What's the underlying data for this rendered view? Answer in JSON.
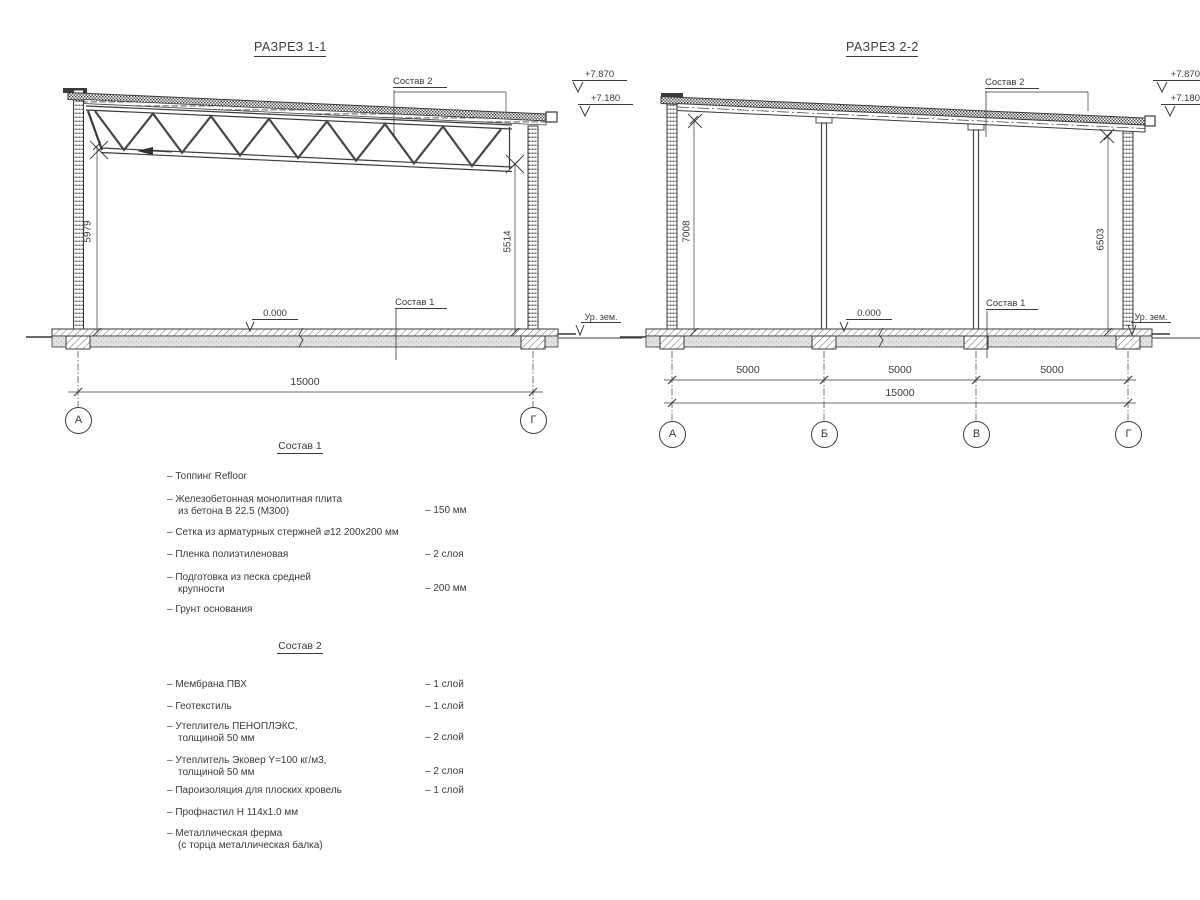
{
  "drawing": {
    "section1": {
      "title": "РАЗРЕЗ 1-1",
      "elev_top": "+7.870",
      "elev_mid": "+7.180",
      "elev_zero": "0.000",
      "ground": "Ур. зем.",
      "callout_roof": "Состав 2",
      "callout_floor": "Состав 1",
      "dim_left": "5979",
      "dim_right": "5514",
      "dim_total": "15000",
      "axes": [
        "А",
        "Г"
      ]
    },
    "section2": {
      "title": "РАЗРЕЗ 2-2",
      "elev_top": "+7.870",
      "elev_mid": "+7.180",
      "elev_zero": "0.000",
      "ground": "Ур. зем.",
      "callout_roof": "Состав 2",
      "callout_floor": "Состав 1",
      "dim_left": "7008",
      "dim_right": "6503",
      "dim_spans": [
        "5000",
        "5000",
        "5000"
      ],
      "dim_total": "15000",
      "axes": [
        "А",
        "Б",
        "В",
        "Г"
      ]
    }
  },
  "lists": {
    "sostav1": {
      "title": "Состав 1",
      "items": [
        {
          "l1": "– Топпинг Refloor",
          "l2": "",
          "val": ""
        },
        {
          "l1": "– Железобетонная монолитная плита",
          "l2": "из бетона В 22.5 (М300)",
          "val": "– 150 мм"
        },
        {
          "l1": "– Сетка из арматурных стержней ⌀12 200x200 мм",
          "l2": "",
          "val": ""
        },
        {
          "l1": "– Пленка полиэтиленовая",
          "l2": "",
          "val": "– 2 слоя"
        },
        {
          "l1": "– Подготовка из песка средней",
          "l2": "крупности",
          "val": "– 200 мм"
        },
        {
          "l1": "– Грунт основания",
          "l2": "",
          "val": ""
        }
      ]
    },
    "sostav2": {
      "title": "Состав 2",
      "items": [
        {
          "l1": "– Мембрана ПВХ",
          "l2": "",
          "val": "– 1 слой"
        },
        {
          "l1": "– Геотекстиль",
          "l2": "",
          "val": "– 1 слой"
        },
        {
          "l1": "– Утеплитель ПЕНОПЛЭКС,",
          "l2": "толщиной 50 мм",
          "val": "– 2 слой"
        },
        {
          "l1": "– Утеплитель Эковер Y=100 кг/м3,",
          "l2": "толщиной 50 мм",
          "val": "– 2 слоя"
        },
        {
          "l1": "– Пароизоляция для плоских кровель",
          "l2": "",
          "val": "– 1 слой"
        },
        {
          "l1": "– Профнастил Н 114x1.0 мм",
          "l2": "",
          "val": ""
        },
        {
          "l1": "– Металлическая ферма",
          "l2": "(с торца металлическая балка)",
          "val": ""
        }
      ]
    }
  },
  "colors": {
    "line": "#3a3a3a",
    "slab": "#e2e2e2"
  }
}
